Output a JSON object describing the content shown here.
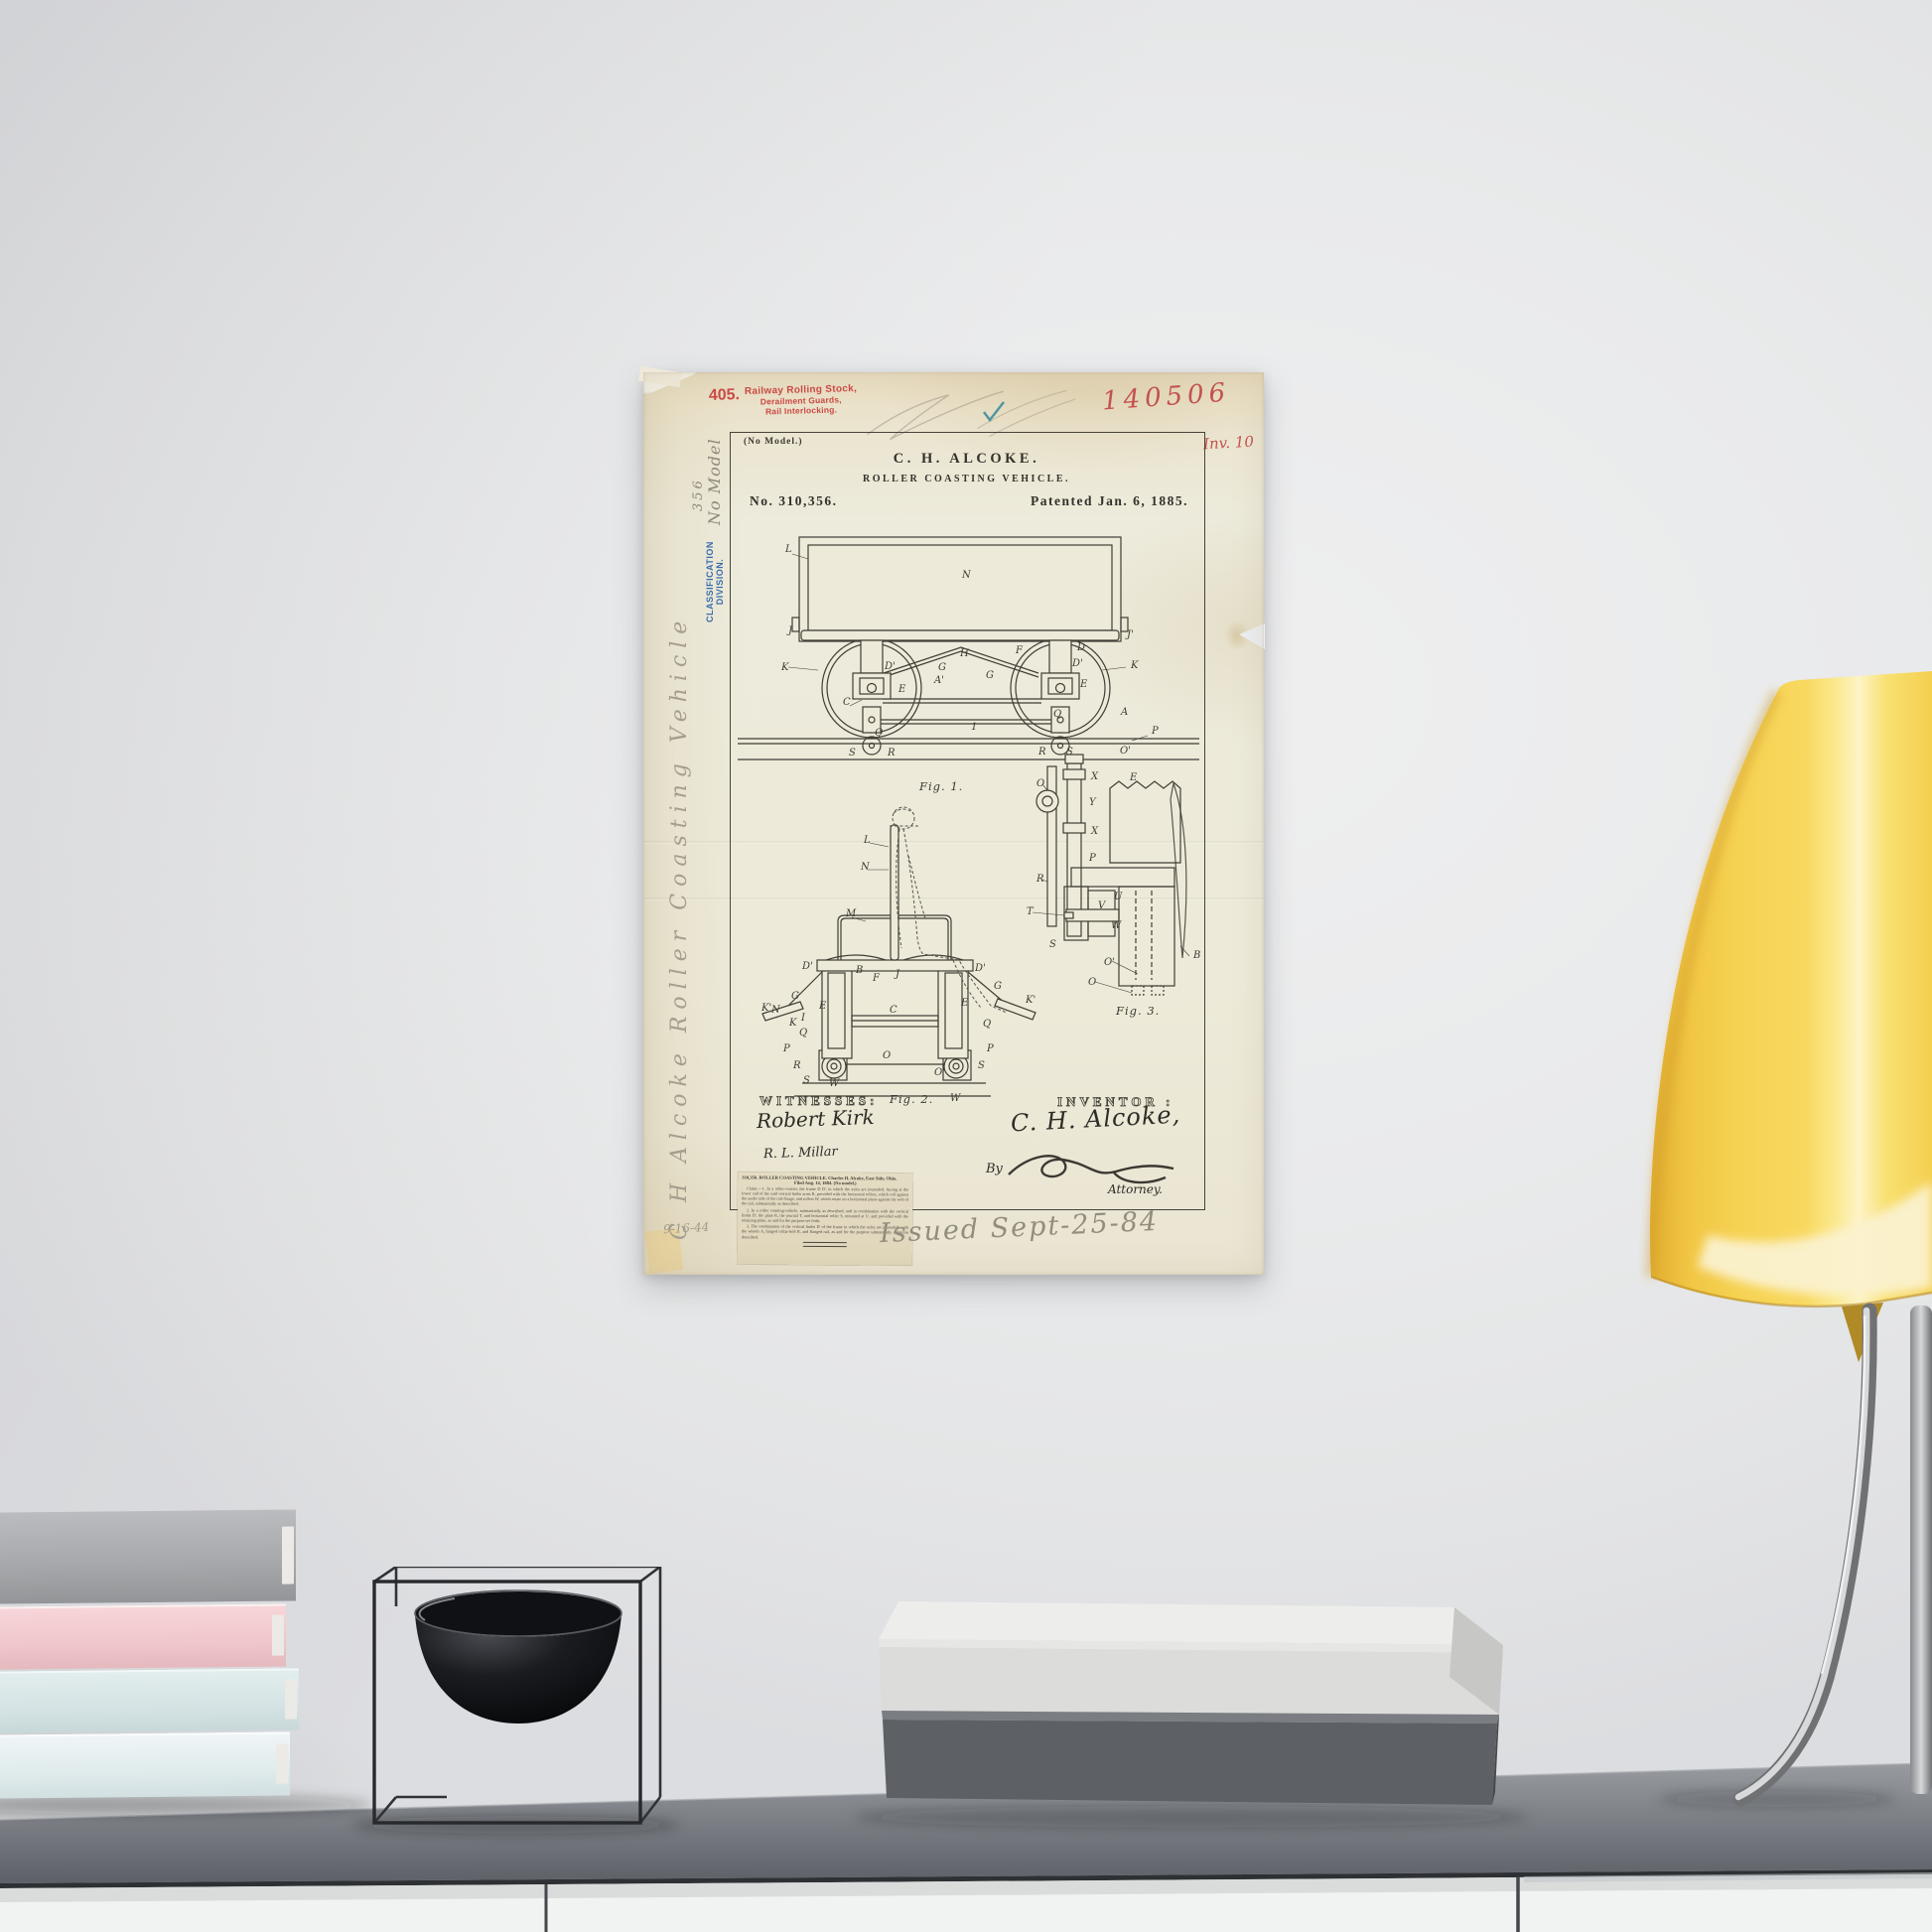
{
  "poster": {
    "serial_handwritten": "140506",
    "margin_fig_note": "Inv. 10",
    "stamp": {
      "number": "405.",
      "lines": [
        "Railway Rolling Stock,",
        "Derailment Guards,",
        "Rail Interlocking."
      ]
    },
    "no_model": "(No Model.)",
    "inventor_name": "C. H. ALCOKE.",
    "invention_title": "ROLLER COASTING VEHICLE.",
    "patent_number": "No. 310,356.",
    "patent_date": "Patented Jan. 6, 1885.",
    "margin": {
      "number": "356",
      "no_model": "No Model",
      "classification": "CLASSIFICATION",
      "division": "DIVISION.",
      "pencil_title": "C H Alcoke  Roller Coasting Vehicle",
      "date_note": "9-16-44"
    },
    "figures": {
      "fig1": {
        "caption": "Fig. 1.",
        "labels": [
          [
            "L",
            143,
            181
          ],
          [
            "N",
            321,
            207
          ],
          [
            "J",
            146,
            263
          ],
          [
            "J'",
            487,
            267
          ],
          [
            "K",
            139,
            300
          ],
          [
            "K",
            491,
            298
          ],
          [
            "D",
            437,
            280
          ],
          [
            "D'",
            243,
            299
          ],
          [
            "D'",
            432,
            296
          ],
          [
            "F",
            375,
            283
          ],
          [
            "H",
            319,
            286
          ],
          [
            "G",
            297,
            300
          ],
          [
            "G",
            345,
            308
          ],
          [
            "A'",
            293,
            313
          ],
          [
            "C",
            201,
            335
          ],
          [
            "E",
            257,
            322
          ],
          [
            "E",
            440,
            317
          ],
          [
            "Q",
            233,
            366
          ],
          [
            "Q",
            413,
            347
          ],
          [
            "1",
            330,
            360
          ],
          [
            "A",
            481,
            345
          ],
          [
            "P",
            512,
            364
          ],
          [
            "S",
            207,
            386
          ],
          [
            "R",
            246,
            386
          ],
          [
            "R",
            398,
            385
          ],
          [
            "S",
            426,
            385
          ],
          [
            "O'",
            480,
            384
          ]
        ]
      },
      "fig2": {
        "caption": "Fig. 2.",
        "labels": [
          [
            "L",
            222,
            474
          ],
          [
            "N",
            219,
            501
          ],
          [
            "M",
            204,
            548
          ],
          [
            "D'",
            160,
            601
          ],
          [
            "B",
            214,
            605
          ],
          [
            "F",
            231,
            613
          ],
          [
            "J",
            254,
            609
          ],
          [
            "D'",
            334,
            603
          ],
          [
            "G",
            353,
            621
          ],
          [
            "G",
            149,
            631
          ],
          [
            "N",
            129,
            645
          ],
          [
            "K",
            147,
            658
          ],
          [
            "K'",
            119,
            643
          ],
          [
            "E",
            177,
            641
          ],
          [
            "E",
            320,
            638
          ],
          [
            "K'",
            385,
            635
          ],
          [
            "I",
            159,
            653
          ],
          [
            "Q",
            157,
            668
          ],
          [
            "Q",
            342,
            659
          ],
          [
            "P",
            141,
            684
          ],
          [
            "P",
            346,
            684
          ],
          [
            "R",
            151,
            701
          ],
          [
            "S",
            161,
            716
          ],
          [
            "W",
            187,
            719
          ],
          [
            "O",
            241,
            691
          ],
          [
            "O'",
            293,
            708
          ],
          [
            "S",
            337,
            701
          ],
          [
            "W",
            309,
            734
          ],
          [
            "C",
            248,
            645
          ]
        ]
      },
      "fig3": {
        "caption": "Fig. 3.",
        "labels": [
          [
            "O",
            396,
            417
          ],
          [
            "X",
            451,
            410
          ],
          [
            "Y",
            449,
            436
          ],
          [
            "X",
            451,
            465
          ],
          [
            "E",
            490,
            411
          ],
          [
            "P",
            449,
            492
          ],
          [
            "R",
            396,
            513
          ],
          [
            "T",
            386,
            546
          ],
          [
            "S",
            409,
            579
          ],
          [
            "U",
            474,
            531
          ],
          [
            "V",
            458,
            540
          ],
          [
            "W",
            471,
            560
          ],
          [
            "O'",
            464,
            597
          ],
          [
            "O",
            448,
            617
          ],
          [
            "B",
            554,
            590
          ]
        ]
      }
    },
    "signature_block": {
      "witnesses_heading": "WITNESSES:",
      "inventor_heading": "INVENTOR :",
      "witness1": "Robert Kirk",
      "witness2": "R. L. Millar",
      "inventor_signature": "C. H. Alcoke,",
      "by_label": "By",
      "attorney_label": "Attorney."
    },
    "clipping": {
      "head_line1": "310,356.  ROLLER COASTING VEHICLE.  Charles H. Alcoke, East Side, Ohio.",
      "head_line2": "Filed Aug. 14, 1884.  (No model.)",
      "claims": [
        "Claim.—1. In a roller-coaster, the frame D D', in which the axles are journaled, having at the lower end of the said vertical limbs arms R, provided with the horizontal rollers, which roll against the under side of the rail-flange, and rollers W, which rotate on a horizontal plane against the web of the rail, substantially as described.",
        "2. In a roller coasting-vehicle, substantially as described, and in combination with the vertical limbs D', the plate R, the journal T, and horizontal roller S, mounted at U, and provided with the retaining-plate, as and for the purpose set forth.",
        "3. The combination of the vertical limbs D' of the frame in which the axles are journaled, with the wheels A, hinged collar-bolt R, and flanged rail, as and for the purpose substantially as herein described."
      ]
    },
    "handwritten_note": "Issued Sept-25-84"
  },
  "scene": {
    "wall_color": "#e9eaeb",
    "desk": {
      "top_color": "#8a8e93",
      "front_color": "#60646a",
      "drawer_color": "#f1f2f2"
    },
    "left_books_colors": [
      "#a7a9ac",
      "#f0c7cb",
      "#d5e3e4",
      "#e0ebec"
    ],
    "kubus_bowl": {
      "frame_color": "#2b2d30",
      "bowl_color": "#121316"
    },
    "center_books_colors": [
      "#e9e9e7",
      "#5d6064"
    ],
    "lamp": {
      "shade_color": "#f5d054",
      "stem_color": "#c9cacc"
    }
  }
}
